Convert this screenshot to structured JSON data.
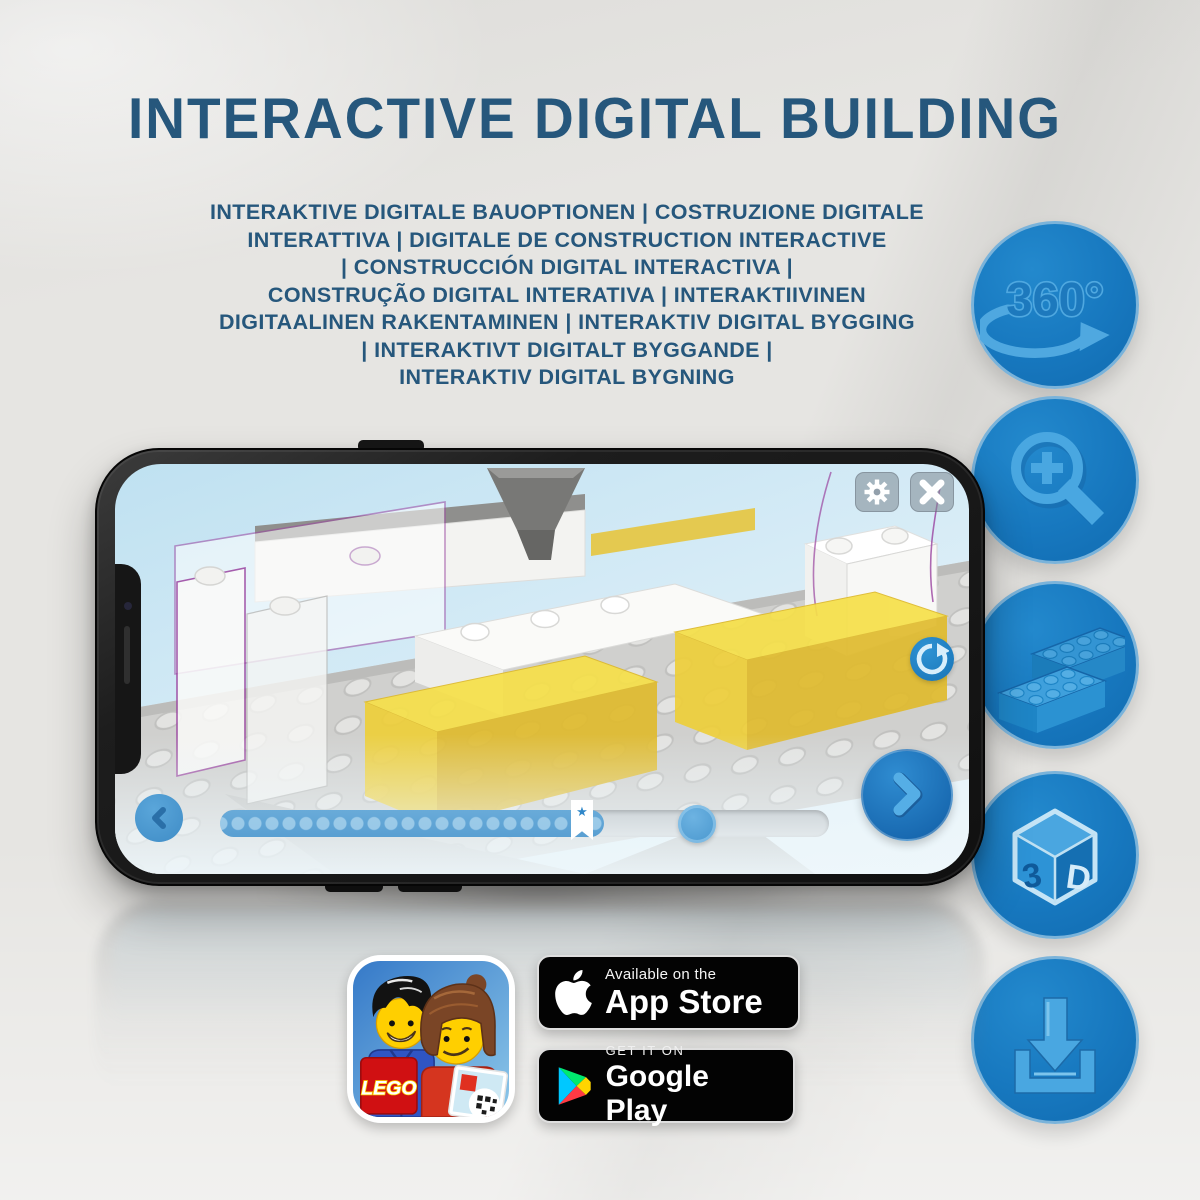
{
  "header": {
    "title": "INTERACTIVE DIGITAL BUILDING"
  },
  "subtitle": {
    "lines": [
      "INTERAKTIVE DIGITALE BAUOPTIONEN | COSTRUZIONE DIGITALE",
      "INTERATTIVA | DIGITALE DE CONSTRUCTION INTERACTIVE",
      "| CONSTRUCCIÓN DIGITAL INTERACTIVA |",
      "CONSTRUÇÃO DIGITAL INTERATIVA | INTERAKTIIVINEN",
      "DIGITAALINEN RAKENTAMINEN | INTERAKTIV DIGITAL BYGGING",
      "| INTERAKTIVT DIGITALT BYGGANDE |",
      "INTERAKTIV DIGITAL BYGNING"
    ]
  },
  "features": {
    "rotation_label": "360°",
    "cube_letters": {
      "three": "3",
      "dee": "D"
    },
    "items": [
      {
        "icon": "360-rotation-icon"
      },
      {
        "icon": "zoom-in-magnifier-icon"
      },
      {
        "icon": "lego-bricks-icon"
      },
      {
        "icon": "3d-view-cube-icon"
      },
      {
        "icon": "download-icon"
      }
    ]
  },
  "phone": {
    "app_ui": {
      "top_buttons": [
        "settings-gear",
        "close"
      ],
      "side_button": "rotate-model",
      "nav_buttons": [
        "previous-step",
        "next-step"
      ],
      "slider": {
        "bookmark_glyph": "★",
        "progress_fraction": 0.63
      }
    }
  },
  "badges": {
    "lego_app": {
      "logo_text": "LEGO"
    },
    "app_store": {
      "tagline": "Available on the",
      "name": "App Store"
    },
    "google_play": {
      "tagline": "GET IT ON",
      "name": "Google Play"
    }
  },
  "colors": {
    "heading_blue": "#26577c",
    "circle_blue": "#1778bf",
    "glyph_light_blue": "#4fa8e0",
    "app_ui_blue": "#4896cd",
    "brick_yellow": "#efcf3a",
    "background_grey": "#e6e5e2"
  }
}
